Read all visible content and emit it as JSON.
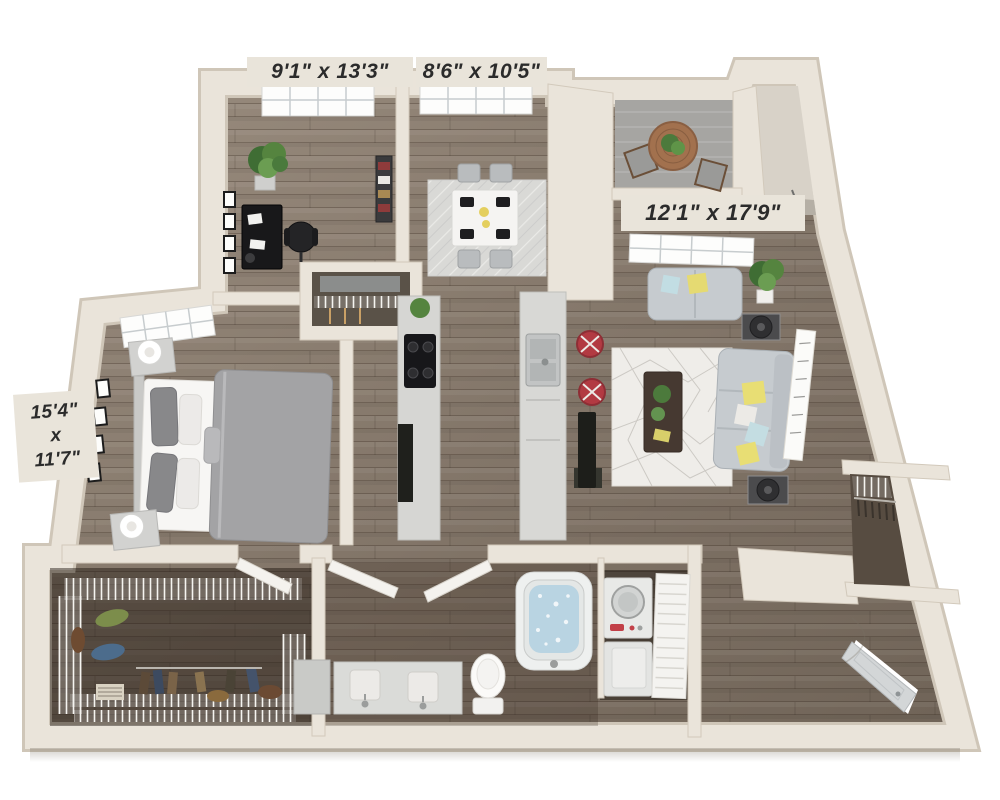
{
  "title": "3D apartment floor plan",
  "floorplan": {
    "view": "3d-top-down-render",
    "dimension_labels": {
      "office": "9'1\" x 13'3\"",
      "dining": "8'6\" x 10'5\"",
      "living": "12'1\" x 17'9\"",
      "bedroom": {
        "line1": "15'4\"",
        "line2": "x",
        "line3": "11'7\""
      }
    },
    "rooms": [
      {
        "id": "office-den",
        "dimensions": "9'1\" x 13'3\"",
        "furniture": [
          "desk",
          "office-chair",
          "potted-plant",
          "wall-frames",
          "bookshelf",
          "window"
        ]
      },
      {
        "id": "dining-room",
        "dimensions": "8'6\" x 10'5\"",
        "furniture": [
          "dining-table",
          "four-chairs",
          "area-rug",
          "window"
        ]
      },
      {
        "id": "balcony",
        "furniture": [
          "bistro-table",
          "two-chairs",
          "potted-plant"
        ]
      },
      {
        "id": "living-room",
        "dimensions": "12'1\" x 17'9\"",
        "furniture": [
          "sofa",
          "loveseat",
          "coffee-table",
          "end-tables",
          "lamps",
          "geometric-rug",
          "wall-art",
          "potted-plants",
          "window",
          "tv"
        ]
      },
      {
        "id": "bedroom",
        "dimensions": "15'4\" x 11'7\"",
        "furniture": [
          "bed",
          "nightstands",
          "lamps",
          "wall-frames",
          "window"
        ]
      },
      {
        "id": "kitchen",
        "furniture": [
          "range-counter",
          "sink-island",
          "bar-stools",
          "pantry-closet"
        ]
      },
      {
        "id": "walk-in-closet",
        "furniture": [
          "wire-shelving",
          "hanging-clothes"
        ]
      },
      {
        "id": "bathroom",
        "furniture": [
          "double-vanity",
          "toilet",
          "bathtub"
        ]
      },
      {
        "id": "laundry-closet",
        "furniture": [
          "stacked-washer-dryer",
          "louvered-door"
        ]
      },
      {
        "id": "entry",
        "furniture": [
          "entry-door",
          "coat-closet"
        ]
      }
    ],
    "colors": {
      "wall": "#eae4da",
      "wall_edge": "#cfc6b8",
      "floor_light": "#8b7e71",
      "floor_dark": "#554a3f",
      "balcony_floor": "#a6a5a2",
      "rug_living": "#efede9",
      "rug_dining": "#d9d9d6",
      "sofa_gray": "#c6cbcf",
      "bed_duvet": "#a3a3a5",
      "accent_yellow": "#e5da72",
      "accent_blue": "#c2dde3",
      "accent_red": "#b23a42",
      "plant_green": "#55843f",
      "water_blue": "#b9d4e2",
      "label_text": "#2b2b2b"
    }
  }
}
